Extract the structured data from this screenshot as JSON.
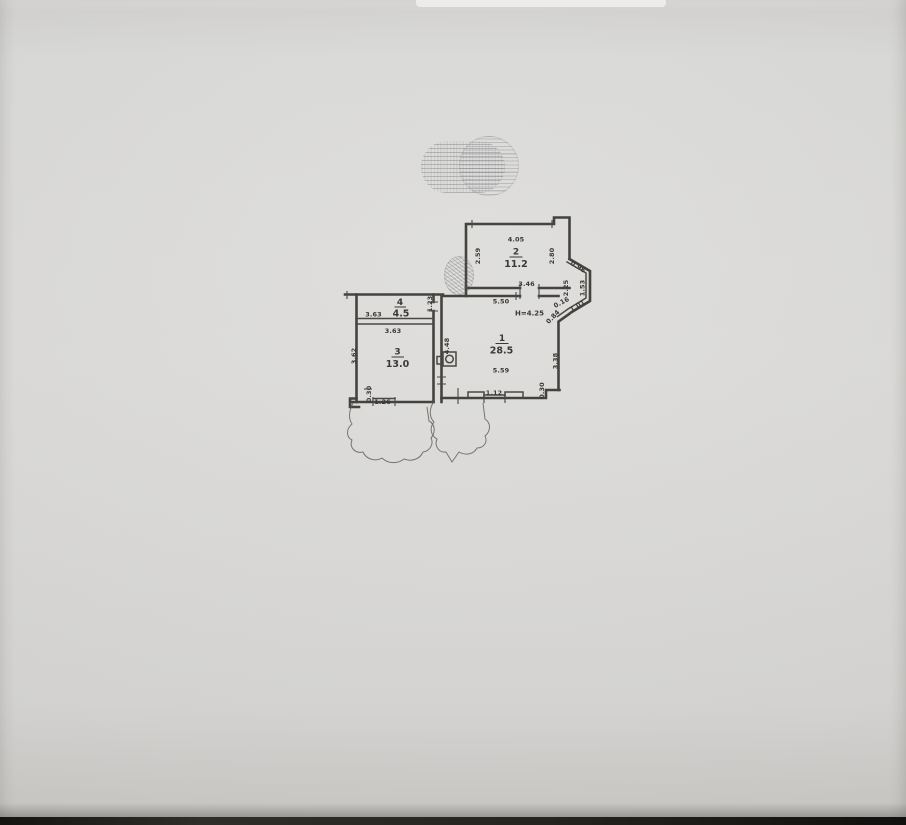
{
  "scan": {
    "paper_color": "#d9d8d6",
    "edge_color": "#1f1e1b",
    "line_color": "#45433f"
  },
  "stamps": {
    "top_stamp": {
      "legible": false,
      "style": "faded-ink-text-lines"
    },
    "round_seal": {
      "legible": false,
      "style": "hatched-circle"
    }
  },
  "floor_plan": {
    "rooms": [
      {
        "number": "1",
        "area": "28.5"
      },
      {
        "number": "2",
        "area": "11.2"
      },
      {
        "number": "3",
        "area": "13.0"
      },
      {
        "number": "4",
        "area": "4.5"
      }
    ],
    "labels": {
      "r2_width": "4.05",
      "r2_left": "2.59",
      "r2_right": "2.80",
      "r2_door_wall": "3.46",
      "r1_top": "5.50",
      "height_note": "H=4.25",
      "r1_left": "4.48",
      "r1_right": "3.38",
      "r1_bottom": "5.59",
      "r1_window": "1.12",
      "r1_wall_offset": "0.30",
      "r4_width": "3.63",
      "r4_depth": "1.23",
      "r3_width": "3.63",
      "r3_left": "3.62",
      "r3_wall_offset": "0.30",
      "r3_window": "1.26",
      "bay_top": "0.96",
      "bay_inner": "2.25",
      "bay_right": "1.53",
      "bay_bottom": "1.01",
      "bay_jog": "0.16",
      "bay_lower": "0.84"
    }
  }
}
